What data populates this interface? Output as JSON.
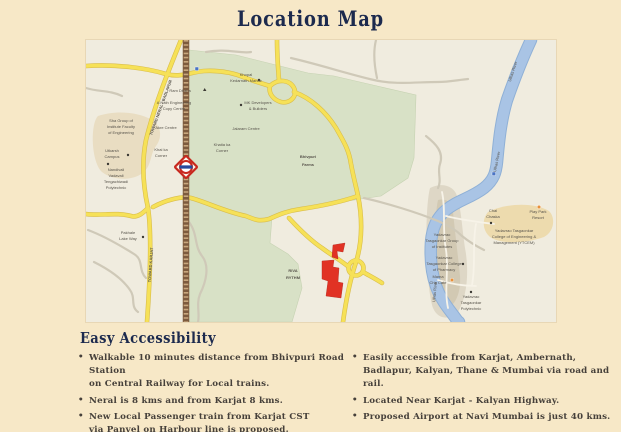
{
  "title": "Location Map",
  "accessibility": {
    "heading": "Easy Accessibility",
    "left": [
      "Walkable 10 minutes distance from Bhivpuri Road Station\non Central Railway for Local trains.",
      "Neral is 8 kms and from Karjat 8 kms.",
      "New Local Passenger train from Karjat CST\nvia Panvel on Harbour line is proposed."
    ],
    "right": [
      "Easily accessible from Karjat, Ambernath,\nBadlapur, Kalyan, Thane & Mumbai via road and rail.",
      "Located Near Karjat - Kalyan Highway.",
      "Proposed Airport at Navi Mumbai is just 40 kms."
    ]
  },
  "map": {
    "region_labels": {
      "farms": [
        "Bhivpuri",
        "Farms"
      ],
      "riva": [
        "RIVA",
        "RYTHM"
      ],
      "river": "Ulhas River",
      "toward_neral": "TOWARD NERAL - BADLAPUR",
      "toward_karjat": "TOWARD KARJAT"
    },
    "poi_labels": {
      "ram_dhaba": "Ram Dhaba",
      "copy_centre": [
        "A Nath Engineering",
        "Copy Centre"
      ],
      "akre_centre": "Akre Centre",
      "jalaram_centre": "Jalaram Centre",
      "khaika_corner": [
        "Khai ka",
        "Corner"
      ],
      "khatia_corner": [
        "Khatia ka",
        "Corner"
      ],
      "mandir": [
        "Khopal",
        "Kedarnath Mandir"
      ],
      "mk_developers": [
        "MK Developers",
        "& Builders"
      ],
      "sha_group": [
        "Sha Group of",
        "Institute Faculty",
        "of Engineering"
      ],
      "utkarsh_campus": [
        "Utkarsh",
        "Campus"
      ],
      "nandivali": [
        "Nandivali",
        "Vadavali",
        "Tengachiwadi",
        "Polytechnic"
      ],
      "pakhale": [
        "Pakhale",
        "Lake Way"
      ],
      "chai_chaska": [
        "Chai",
        "Chaska"
      ],
      "play_park": [
        "Play Park",
        "Resort"
      ],
      "ytg_institutes": [
        "Yadavrao",
        "Tasgaonkar Group",
        "of Institutes"
      ],
      "yt_pharmacy": [
        "Yadavrao",
        "Tasgaonkar College",
        "of Pharmacy"
      ],
      "mama_cafe": [
        "Mama",
        "Cha Café"
      ],
      "yt_polytechnic": [
        "Yadavrao",
        "Tasgaonkar",
        "Polytechnic"
      ],
      "ytcem": [
        "Yadavrao Tasgaonkar",
        "College of Engineering &",
        "Management (YTCEM)"
      ]
    }
  },
  "colors": {
    "page-bg": "#f7e8c7",
    "title-ink": "#1c2a4e",
    "body-ink": "#46403a",
    "map-bg": "#f0ecdf",
    "map-green": "#d8e1c6",
    "urban-tan": "#e9ddc2",
    "road-yellow": "#f6e158",
    "road-casing": "#d9bd4a",
    "road-gray": "#cfc9b8",
    "river-blue": "#a9c4e5",
    "river-edge": "#8fb0d6",
    "railway-brown": "#7d5b3e",
    "railway-tie": "#c9a87e",
    "riva-red": "#e13224"
  }
}
